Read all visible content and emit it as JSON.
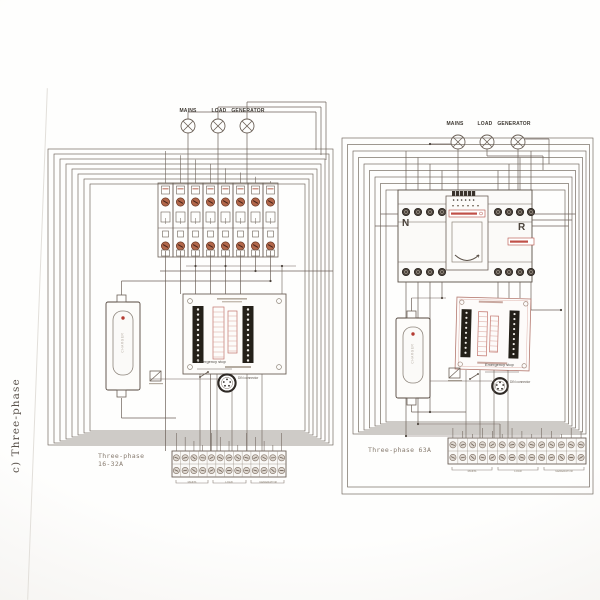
{
  "page": {
    "side_label": "c) Three-phase"
  },
  "left_diagram": {
    "caption_line1": "Three-phase",
    "caption_line2": "16-32A",
    "indicators": {
      "mains": "MAINS",
      "load": "LOAD",
      "generator": "GENERATOR"
    },
    "emergency_stop_label": "Emergency stop",
    "connector_label": "DIN connector",
    "charger_label": "CHARGER",
    "terminal_groups": {
      "mains": "MAINS",
      "load": "LOAD",
      "generator": "GENERATOR"
    }
  },
  "right_diagram": {
    "caption": "Three-phase 63A",
    "indicators": {
      "mains": "MAINS",
      "load": "LOAD",
      "generator": "GENERATOR"
    },
    "ats_labels": {
      "left": "N",
      "right": "R"
    },
    "emergency_stop_label": "Emergency stop",
    "connector_label": "DIN connector",
    "charger_label": "CHARGER",
    "terminal_groups": {
      "mains": "MAINS",
      "load": "LOAD",
      "generator": "GENERATOR"
    }
  }
}
